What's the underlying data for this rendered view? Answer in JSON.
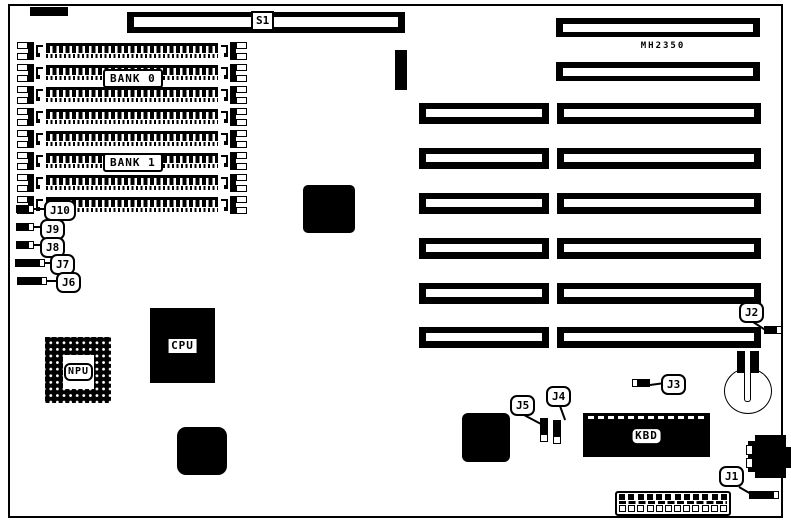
{
  "board": {
    "model": "MH2350",
    "dip_switch_label": "S1"
  },
  "memory": {
    "bank_labels": [
      "BANK 0",
      "BANK 1"
    ],
    "sockets_per_bank": 4
  },
  "chips": {
    "cpu_label": "CPU",
    "npu_label": "NPU",
    "kbd_label": "KBD"
  },
  "jumpers": [
    {
      "id": "j1",
      "label": "J1",
      "pins": [
        1,
        1,
        1,
        1,
        0
      ]
    },
    {
      "id": "j2",
      "label": "J2",
      "pins": [
        1,
        1,
        0
      ]
    },
    {
      "id": "j3",
      "label": "J3",
      "pins": [
        0,
        1,
        1
      ]
    },
    {
      "id": "j4",
      "label": "J4",
      "pins": [
        1,
        1,
        0
      ]
    },
    {
      "id": "j5",
      "label": "J5",
      "pins": [
        1,
        1,
        0
      ]
    },
    {
      "id": "j6",
      "label": "J6",
      "pins": [
        1,
        1,
        1,
        1,
        0
      ]
    },
    {
      "id": "j7",
      "label": "J7",
      "pins": [
        1,
        1,
        1,
        1,
        0
      ]
    },
    {
      "id": "j8",
      "label": "J8",
      "pins": [
        1,
        1,
        0
      ]
    },
    {
      "id": "j9",
      "label": "J9",
      "pins": [
        1,
        1,
        0
      ]
    },
    {
      "id": "j10",
      "label": "J10",
      "pins": [
        1,
        1,
        0
      ]
    }
  ],
  "expansion_slots": {
    "short_top_slots": 2,
    "full_length_slots": 6
  },
  "bottom_header_pin_count": 12
}
